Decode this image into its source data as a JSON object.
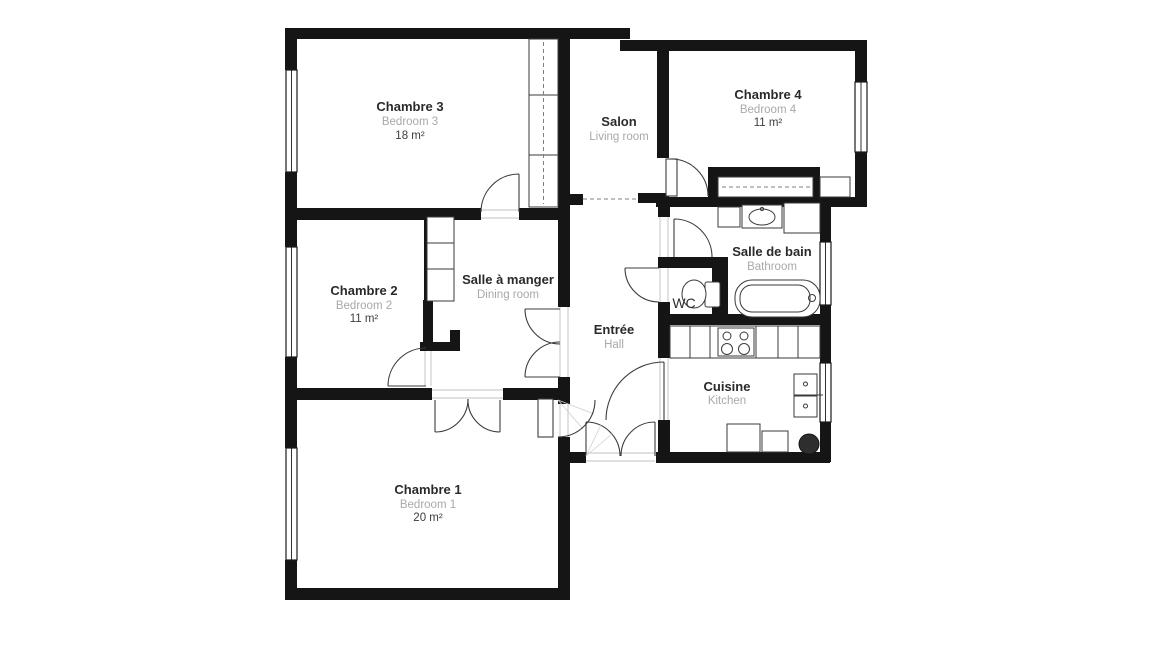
{
  "colors": {
    "background": "#ffffff",
    "wall": "#151515",
    "line": "#3a3a3a",
    "door": "#3c3c3c",
    "name": "#2a2a2a",
    "subtitle": "#a9a9a9",
    "area": "#3d3d3d",
    "dash": "#808080",
    "sill": "#c0c0c0"
  },
  "rooms": {
    "chambre3": {
      "name": "Chambre 3",
      "subtitle": "Bedroom 3",
      "area": "18 m²"
    },
    "salon": {
      "name": "Salon",
      "subtitle": "Living room"
    },
    "chambre4": {
      "name": "Chambre 4",
      "subtitle": "Bedroom 4",
      "area": "11 m²"
    },
    "chambre2": {
      "name": "Chambre 2",
      "subtitle": "Bedroom 2",
      "area": "11 m²"
    },
    "salle_a_manger": {
      "name": "Salle à manger",
      "subtitle": "Dining room"
    },
    "salle_de_bain": {
      "name": "Salle de bain",
      "subtitle": "Bathroom"
    },
    "wc": {
      "name": "WC"
    },
    "entree": {
      "name": "Entrée",
      "subtitle": "Hall"
    },
    "cuisine": {
      "name": "Cuisine",
      "subtitle": "Kitchen"
    },
    "chambre1": {
      "name": "Chambre 1",
      "subtitle": "Bedroom 1",
      "area": "20 m²"
    }
  }
}
